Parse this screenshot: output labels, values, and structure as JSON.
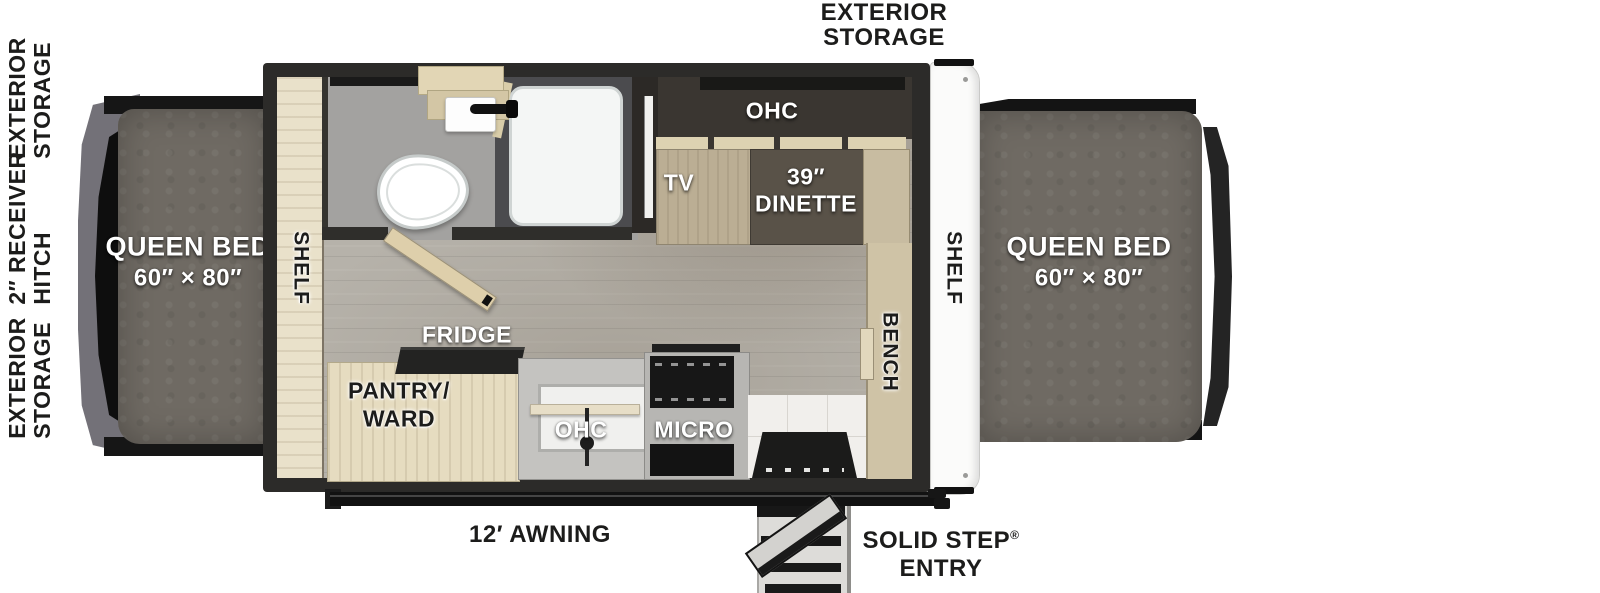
{
  "exterior": {
    "left_labels": [
      {
        "line1": "EXTERIOR",
        "line2": "STORAGE"
      },
      {
        "line1": "2″ RECEIVER",
        "line2": "HITCH"
      },
      {
        "line1": "EXTERIOR",
        "line2": "STORAGE"
      }
    ],
    "top_label": {
      "line1": "EXTERIOR",
      "line2": "STORAGE"
    },
    "awning_label": "12′ AWNING",
    "entry_label": {
      "line1": "SOLID STEP",
      "reg": "®",
      "line2": "ENTRY"
    }
  },
  "beds": {
    "left": {
      "name": "QUEEN BED",
      "size": "60″ × 80″"
    },
    "right": {
      "name": "QUEEN BED",
      "size": "60″ × 80″"
    }
  },
  "interior": {
    "shelf_left": "SHELF",
    "shelf_right": "SHELF",
    "bench": "BENCH",
    "tv": "TV",
    "ohc_dinette": "OHC",
    "dinette_size": "39″",
    "dinette": "DINETTE",
    "fridge": "FRIDGE",
    "pantry_line1": "PANTRY/",
    "pantry_line2": "WARD",
    "ohc_kitchen": "OHC",
    "micro": "MICRO"
  },
  "colors": {
    "wall": "#2c2b29",
    "floor": "#b6b2aa",
    "wood_light": "#e6dcc0",
    "wood_mid": "#bbae94",
    "table_brown": "#595248",
    "mattress": "#6f6a63",
    "tent_gray": "#737178",
    "counter_gray": "#c4c3c0",
    "panel_white": "#fbfbfa",
    "bath_floor": "#a3a2a0",
    "shower_dark": "#4b4b4e",
    "text_dark": "#1c1c1b",
    "text_white": "#ffffff"
  }
}
